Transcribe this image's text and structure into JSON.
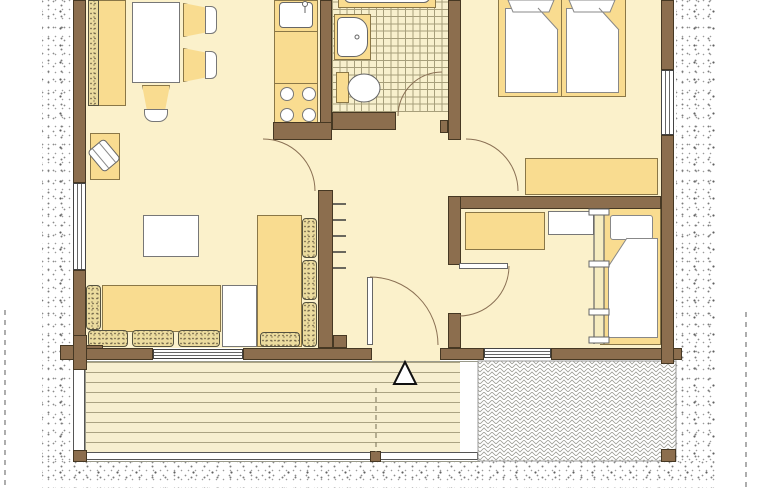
{
  "diagram": {
    "type": "floor-plan",
    "style": "architectural top-down drawing, cut off at top edge, no text labels",
    "rooms": [
      {
        "name": "living-dining-room",
        "furniture": [
          "wall-bench-with-cushion",
          "dining-table",
          "dining-chair-upper",
          "dining-chair-lower",
          "dining-chair-bottom",
          "armchair-on-rug",
          "coffee-table",
          "corner-sofa-seats",
          "sofa-back-cushions",
          "sofa-side-table"
        ]
      },
      {
        "name": "kitchen",
        "furniture": [
          "countertop",
          "sink-with-faucet",
          "stove-four-burners"
        ]
      },
      {
        "name": "bathroom",
        "floor": "tiled",
        "furniture": [
          "bathtub",
          "washbasin",
          "toilet"
        ]
      },
      {
        "name": "bedroom-large",
        "furniture": [
          "double-bed-two-duvets",
          "sideboard"
        ]
      },
      {
        "name": "bedroom-small",
        "furniture": [
          "wardrobe",
          "desk",
          "wall-ladder",
          "single-bed-with-pillow-and-duvet"
        ]
      },
      {
        "name": "hallway",
        "furniture": [
          "coat-hooks"
        ]
      },
      {
        "name": "wood-deck",
        "features": [
          "plank-flooring",
          "entrance-triangle-marker",
          "edge-boards",
          "support-posts",
          "section-dashed-line"
        ]
      },
      {
        "name": "paved-patio",
        "features": [
          "herringbone-paving"
        ]
      }
    ],
    "openings": {
      "windows": 4,
      "door_swing_arcs": 5,
      "door_leaves": 2
    },
    "markers": {
      "entrance_arrow": "white triangle with black outline on deck",
      "boundary_lines": "vertical gray dashed lines at left margin, right margin and through deck"
    }
  },
  "colors": {
    "wall": "#8C6E4E",
    "wallEdge": "#463823",
    "floor": "#FBF1CB",
    "furn": "#F9DC90",
    "furnEdge": "#8A7747",
    "tileBase": "#F8F0CD",
    "tileLine": "#A79F7B",
    "plankLine": "#ABA383",
    "cushionBase": "#EBDB9E",
    "cushionDot": "#6B5F45",
    "cushionEdge": "#55523F",
    "arc": "#8A7054",
    "dash": "#777777",
    "herringboneLine": "#9B9B93"
  }
}
